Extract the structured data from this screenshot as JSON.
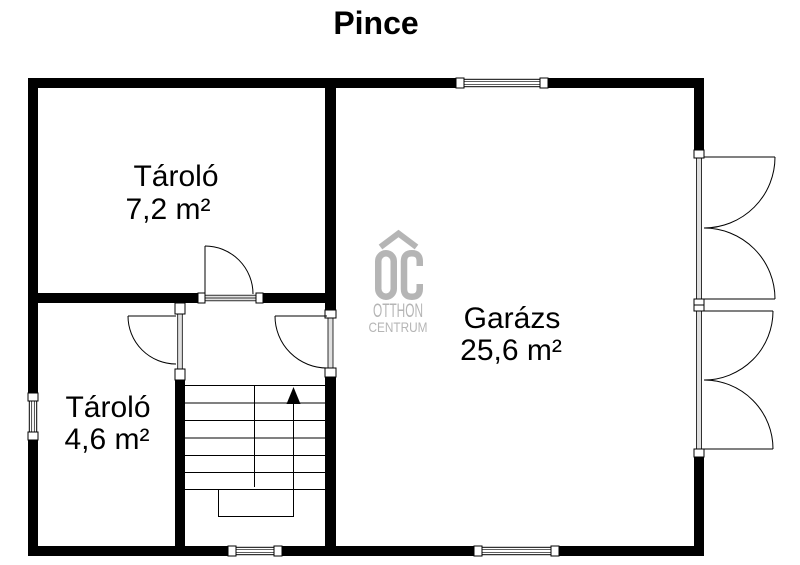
{
  "title": "Pince",
  "rooms": [
    {
      "name": "Tároló",
      "area": "7,2 m²"
    },
    {
      "name": "Garázs",
      "area": "25,6 m²"
    },
    {
      "name": "Tároló",
      "area": "4,6 m²"
    }
  ],
  "watermark": {
    "monogram": "OC",
    "line1": "OTTHON",
    "line2": "CENTRUM",
    "color": "#b5b5b5"
  },
  "colors": {
    "wall": "#000000",
    "background": "#ffffff",
    "line": "#000000"
  }
}
